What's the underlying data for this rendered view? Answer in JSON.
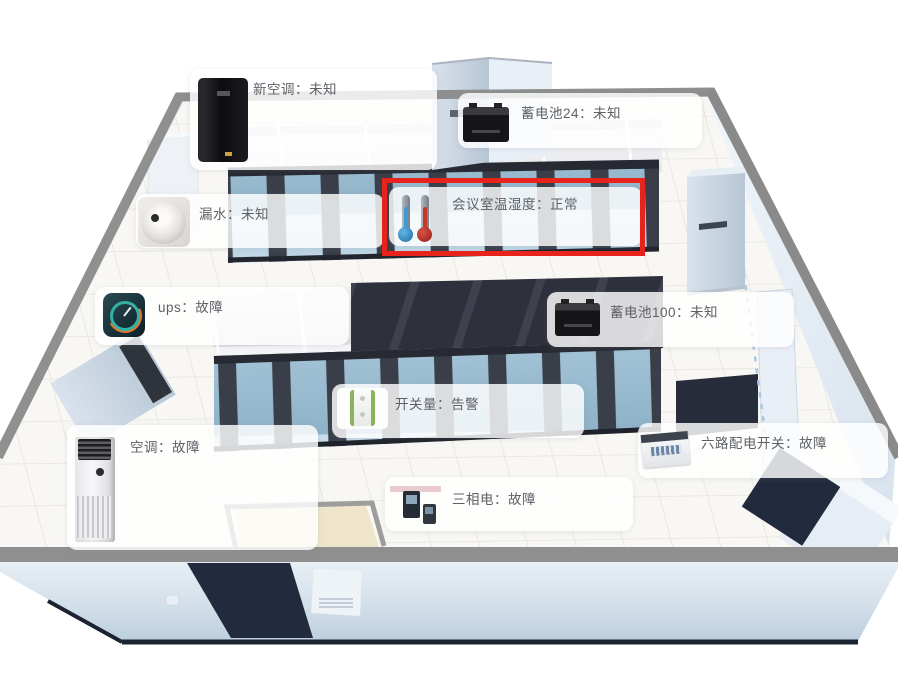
{
  "scene": {
    "description": "3D machine room monitoring view",
    "highlight_color": "#e8231c",
    "colors": {
      "wall_gray": "#8f8f8f",
      "floor": "#f8f7f4",
      "rack_frame": "#3a3e49",
      "rack_glass": "#aecbdd",
      "door_navy": "#232b3d",
      "outer_wall": "#d4e0ea"
    }
  },
  "labels": [
    {
      "id": "new-ac",
      "name": "新空调",
      "status": "未知",
      "text": "新空调：未知",
      "icon": "ups-cabinet-icon",
      "highlighted": false
    },
    {
      "id": "battery24",
      "name": "蓄电池24",
      "status": "未知",
      "text": "蓄电池24：未知",
      "icon": "battery-icon",
      "highlighted": false
    },
    {
      "id": "conference",
      "name": "会议室温湿度",
      "status": "正常",
      "text": "会议室温湿度：正常",
      "icon": "thermometer-icons",
      "highlighted": true
    },
    {
      "id": "leak",
      "name": "漏水",
      "status": "未知",
      "text": "漏水：未知",
      "icon": "leak-sensor-icon",
      "highlighted": false
    },
    {
      "id": "ups",
      "name": "ups",
      "status": "故障",
      "text": "ups：故障",
      "icon": "gauge-icon",
      "highlighted": false
    },
    {
      "id": "battery100",
      "name": "蓄电池100",
      "status": "未知",
      "text": "蓄电池100：未知",
      "icon": "battery-icon",
      "highlighted": false
    },
    {
      "id": "io",
      "name": "开关量",
      "status": "告警",
      "text": "开关量：告警",
      "icon": "io-module-icon",
      "highlighted": false
    },
    {
      "id": "ac",
      "name": "空调",
      "status": "故障",
      "text": "空调：故障",
      "icon": "floor-ac-icon",
      "highlighted": false
    },
    {
      "id": "dist",
      "name": "六路配电开关",
      "status": "故障",
      "text": "六路配电开关：故障",
      "icon": "distribution-box-icon",
      "highlighted": false
    },
    {
      "id": "threephase",
      "name": "三相电",
      "status": "故障",
      "text": "三相电：故障",
      "icon": "power-meter-icons",
      "highlighted": false
    }
  ]
}
